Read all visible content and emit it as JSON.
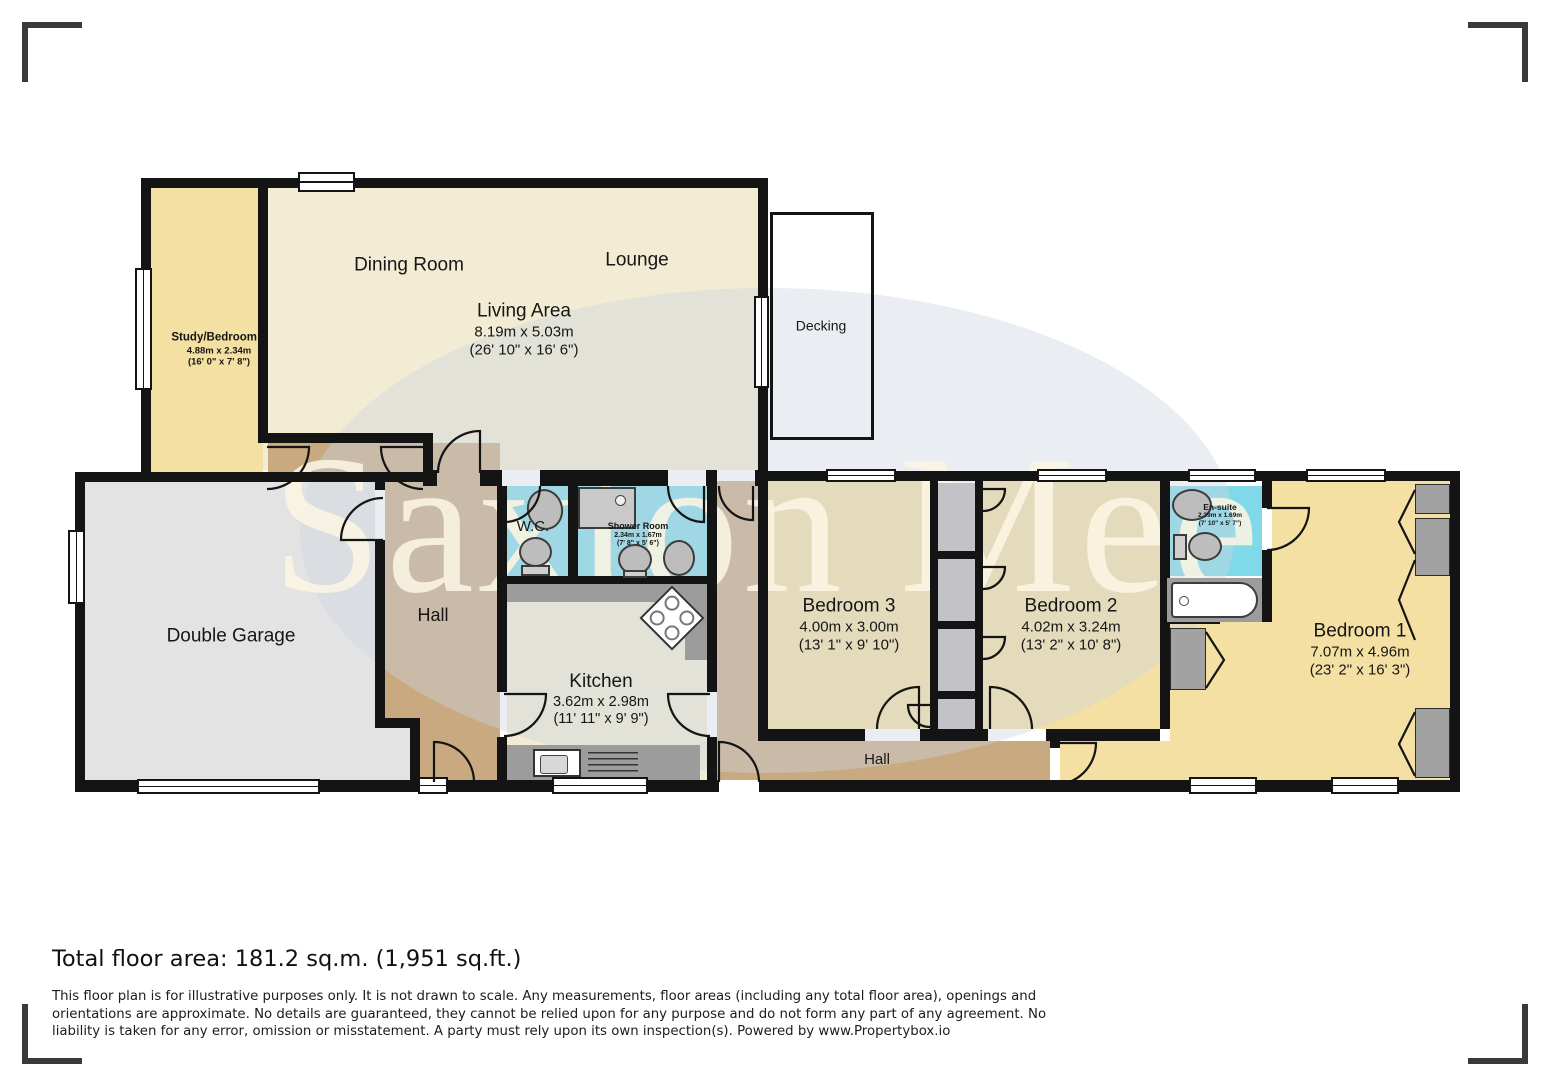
{
  "watermark": {
    "text": "Saxton Mee"
  },
  "rooms": {
    "dining": {
      "name": "Dining Room"
    },
    "lounge": {
      "name": "Lounge"
    },
    "living": {
      "name": "Living Area",
      "metric": "8.19m x 5.03m",
      "imperial": "(26' 10\" x 16' 6\")"
    },
    "decking": {
      "name": "Decking"
    },
    "study": {
      "name": "Study/Bedroom 4",
      "metric": "4.88m x 2.34m",
      "imperial": "(16' 0\" x 7' 8\")"
    },
    "garage": {
      "name": "Double Garage"
    },
    "hall": {
      "name": "Hall"
    },
    "wc": {
      "name": "W.C."
    },
    "shower": {
      "name": "Shower Room",
      "metric": "2.34m x 1.67m",
      "imperial": "(7' 8\" x 5' 6\")"
    },
    "kitchen": {
      "name": "Kitchen",
      "metric": "3.62m x 2.98m",
      "imperial": "(11' 11\" x 9' 9\")"
    },
    "bed3": {
      "name": "Bedroom 3",
      "metric": "4.00m x 3.00m",
      "imperial": "(13' 1\" x 9' 10\")"
    },
    "bed2": {
      "name": "Bedroom 2",
      "metric": "4.02m x 3.24m",
      "imperial": "(13' 2\" x 10' 8\")"
    },
    "ensuite": {
      "name": "En-suite",
      "metric": "2.39m x 1.69m",
      "imperial": "(7' 10\" x 5' 7\")"
    },
    "bed1": {
      "name": "Bedroom 1",
      "metric": "7.07m x 4.96m",
      "imperial": "(23' 2\" x 16' 3\")"
    },
    "hall2": {
      "name": "Hall"
    }
  },
  "footer": {
    "total_area": "Total floor area: 181.2 sq.m. (1,951 sq.ft.)",
    "disclaimer": "This floor plan is for illustrative purposes only. It is not drawn to scale. Any measurements, floor areas (including any total floor area), openings and orientations are approximate. No details are guaranteed, they cannot be relied upon for any purpose and do not form any part of any agreement. No liability is taken for any error, omission or misstatement. A party must rely upon its own inspection(s). Powered by www.Propertybox.io"
  }
}
